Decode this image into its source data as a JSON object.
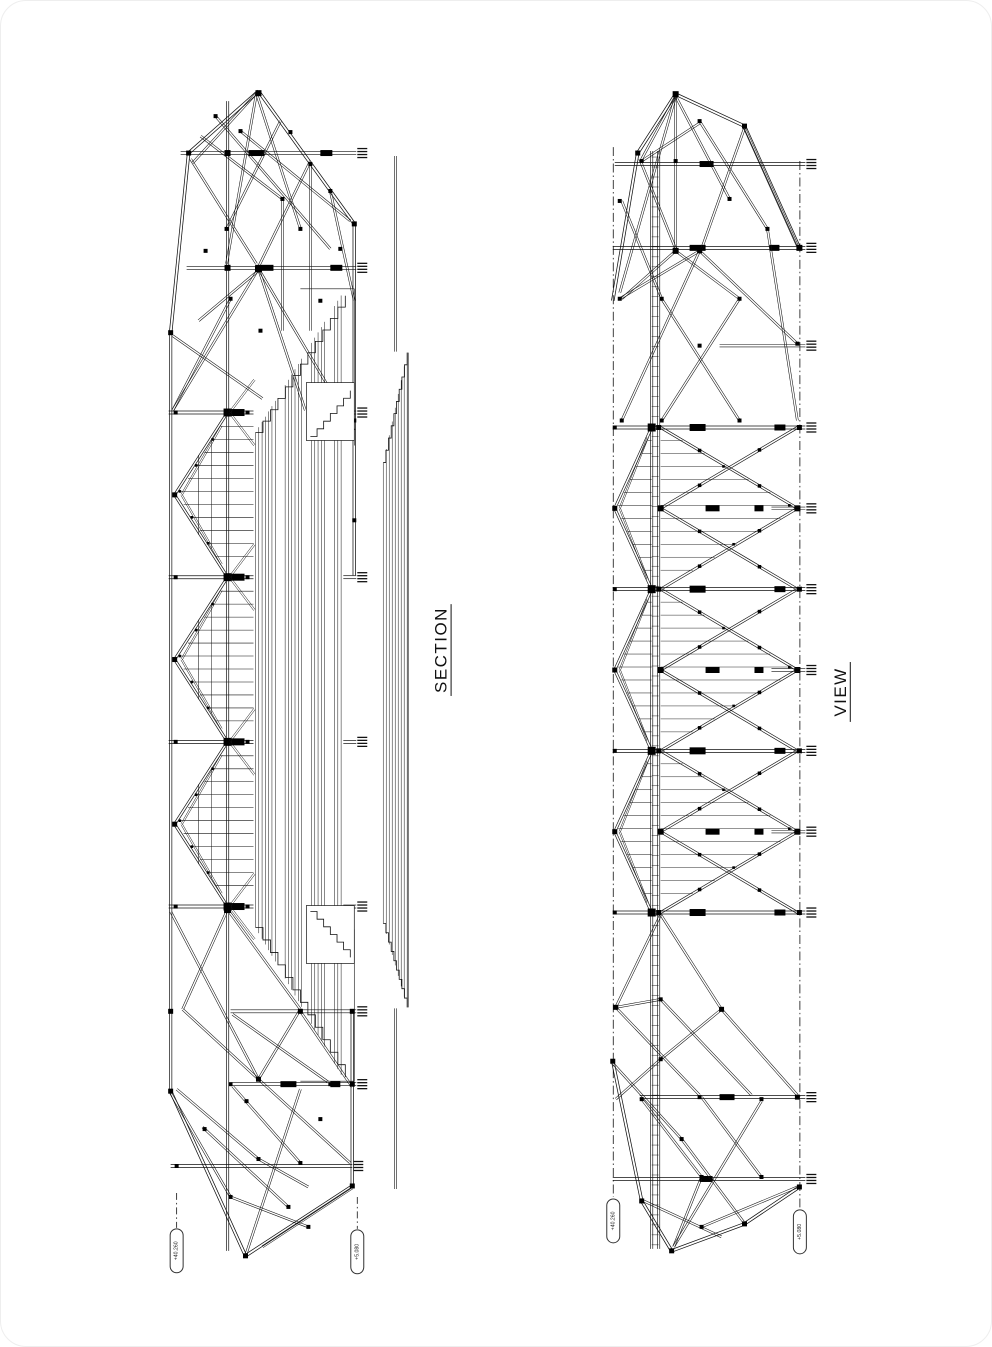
{
  "page": {
    "background": "#ffffff",
    "ink": "#111111"
  },
  "drawings": {
    "section": {
      "title": "SECTION",
      "elevation_left": "+40.260",
      "elevation_right": "+5.080"
    },
    "view": {
      "title": "VIEW",
      "elevation_left": "+40.260",
      "elevation_right": "+5.080"
    }
  }
}
